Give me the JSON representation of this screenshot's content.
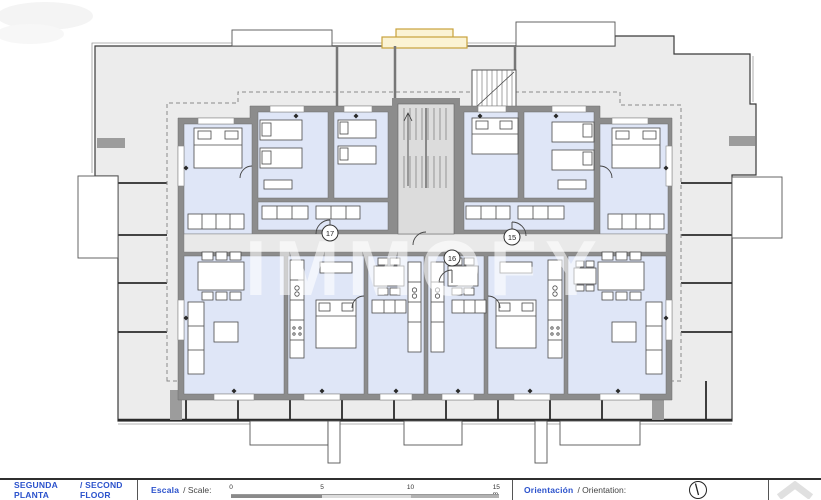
{
  "title": "Second floor plan",
  "watermark": "IMMOFY",
  "units": [
    {
      "number": "15"
    },
    {
      "number": "16"
    },
    {
      "number": "17"
    }
  ],
  "footer": {
    "floor": {
      "es": "SEGUNDA PLANTA",
      "en": "/ SECOND FLOOR"
    },
    "scale": {
      "es": "Escala",
      "rest": "/ Scale:",
      "ticks": [
        "0",
        "5",
        "10",
        "15 m"
      ]
    },
    "orientation": {
      "es": "Orientación",
      "rest": "/ Orientation:"
    }
  },
  "colors": {
    "accent_blue": "#2b52cc",
    "terrace": "#ececec",
    "room": "#dfe6f7",
    "wall": "#8c8c8c",
    "highlight_yellow": "#fbf3d4",
    "yellow_stroke": "#c8a23c"
  }
}
